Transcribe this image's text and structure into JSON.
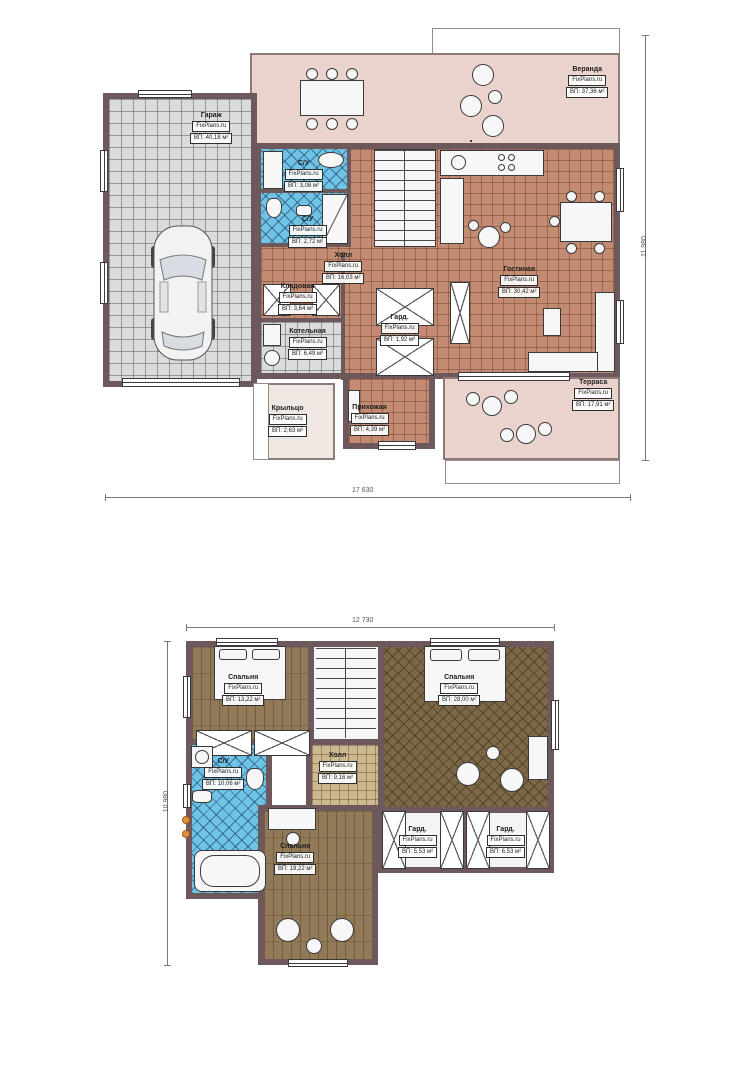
{
  "document": {
    "type": "house floor plans",
    "brand": "FixPlans.ru"
  },
  "palette": {
    "wall": "#6d585c",
    "terracotta_tile": "#c28b72",
    "veranda_pink": "#ebd3cd",
    "bathroom_blue": "#6fc4e6",
    "garage_gray": "#dbdbdb",
    "wood_floor": "#927a59",
    "herringbone_wood": "#7c6746",
    "hall_beige": "#cdb98f"
  },
  "floor1": {
    "dim_width": "17 630",
    "dim_height": "11 980",
    "rooms": {
      "veranda": {
        "name": "Веранда",
        "brand": "FixPlans.ru",
        "area": "ВП: 37,36 м²"
      },
      "garage": {
        "name": "Гараж",
        "brand": "FixPlans.ru",
        "area": "ВП: 40,18 м²"
      },
      "su1": {
        "name": "С/У",
        "brand": "FixPlans.ru",
        "area": "ВП: 3,08 м²"
      },
      "su2": {
        "name": "С/У",
        "brand": "FixPlans.ru",
        "area": "ВП: 2,72 м²"
      },
      "hall": {
        "name": "Холл",
        "brand": "FixPlans.ru",
        "area": "ВП: 16,03 м²"
      },
      "kladovaya": {
        "name": "Кладовая",
        "brand": "FixPlans.ru",
        "area": "ВП: 3,64 м²"
      },
      "kotelnaya": {
        "name": "Котельная",
        "brand": "FixPlans.ru",
        "area": "ВП: 6,49 м²"
      },
      "gard": {
        "name": "Гард.",
        "brand": "FixPlans.ru",
        "area": "ВП: 1,92 м²"
      },
      "gostinaya": {
        "name": "Гостиная",
        "brand": "FixPlans.ru",
        "area": "ВП: 30,42 м²"
      },
      "prihozhaya": {
        "name": "Прихожая",
        "brand": "FixPlans.ru",
        "area": "ВП: 4,39 м²"
      },
      "kryltso": {
        "name": "Крыльцо",
        "brand": "FixPlans.ru",
        "area": "ВП: 2,63 м²"
      },
      "terrasa": {
        "name": "Терраса",
        "brand": "FixPlans.ru",
        "area": "ВП: 17,91 м²"
      }
    }
  },
  "floor2": {
    "dim_width": "12 730",
    "dim_height": "10 980",
    "rooms": {
      "bedroom1": {
        "name": "Спальня",
        "brand": "FixPlans.ru",
        "area": "ВП: 13,22 м²"
      },
      "bedroom2": {
        "name": "Спальня",
        "brand": "FixPlans.ru",
        "area": "ВП: 28,00 м²"
      },
      "su": {
        "name": "С/У",
        "brand": "FixPlans.ru",
        "area": "ВП: 10,06 м²"
      },
      "hall": {
        "name": "Холл",
        "brand": "FixPlans.ru",
        "area": "ВП: 9,16 м²"
      },
      "bedroom3": {
        "name": "Спальня",
        "brand": "FixPlans.ru",
        "area": "ВП: 19,22 м²"
      },
      "gard1": {
        "name": "Гард.",
        "brand": "FixPlans.ru",
        "area": "ВП: 5,53 м²"
      },
      "gard2": {
        "name": "Гард.",
        "brand": "FixPlans.ru",
        "area": "ВП: 6,53 м²"
      }
    }
  }
}
